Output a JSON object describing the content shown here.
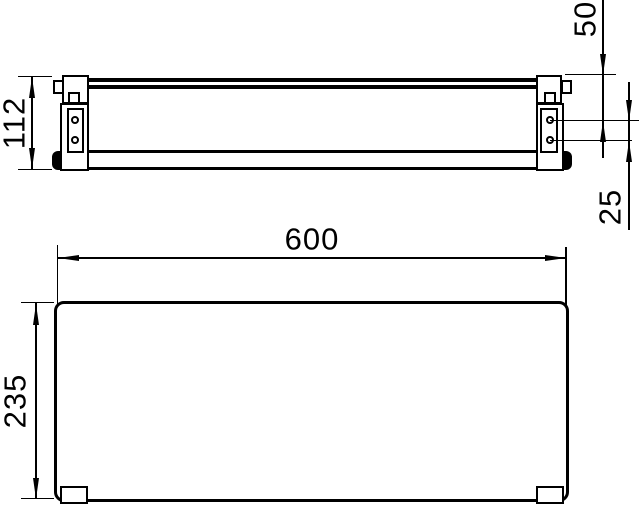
{
  "page": {
    "background_color": "#ffffff",
    "line_color": "#000000"
  },
  "front_view": {
    "description": "front elevation of wall-mounted shelf with two brackets",
    "dim_bracket_height": "112",
    "dim_top_to_upper_hole": "50",
    "dim_hole_spacing": "25"
  },
  "plan_view": {
    "description": "top plan of shelf plate with two wall feet",
    "dim_width": "600",
    "dim_depth": "235"
  }
}
